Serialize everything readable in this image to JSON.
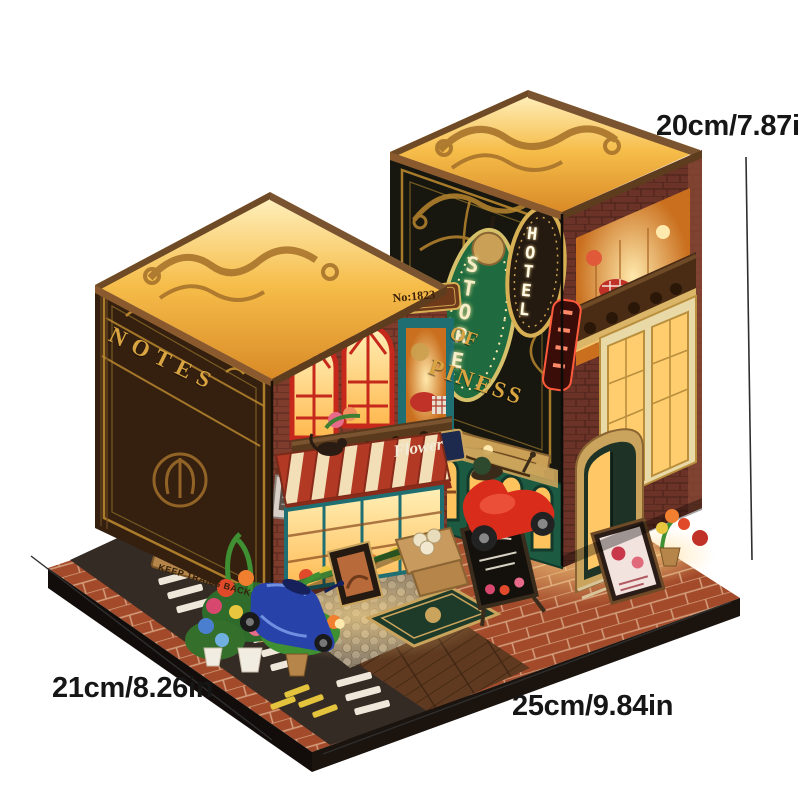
{
  "annotations": {
    "height_label": "20cm/7.87in",
    "depth_label": "21cm/8.26in",
    "width_label": "25cm/9.84in",
    "text_color": "#161616",
    "line_color": "#2e2e2e"
  },
  "model": {
    "left_building": {
      "cover_sign": "NOTES",
      "door_plaque": "No:1823",
      "shop_sign": "Flower",
      "wall_plank_sign": "KEEP TRAILS BACK"
    },
    "right_building": {
      "store_sign": "STORE",
      "hotel_sign": "HOTEL",
      "cover_text_line1": "OF",
      "cover_text_line2": "PINESS"
    },
    "colors": {
      "roof_glow": "#ffcf6e",
      "brick": "#7e3c2c",
      "left_cover": "#3a2313",
      "right_cover": "#17170f",
      "gold": "#c9952c",
      "teal_door": "#1f7e7f",
      "awning_red": "#b23a25",
      "awning_cream": "#f2dfb8",
      "storefront_green": "#1f5c44",
      "scooter_red": "#d92f1f",
      "scooter_blue": "#2b3f9e",
      "base": "#17120e"
    }
  }
}
